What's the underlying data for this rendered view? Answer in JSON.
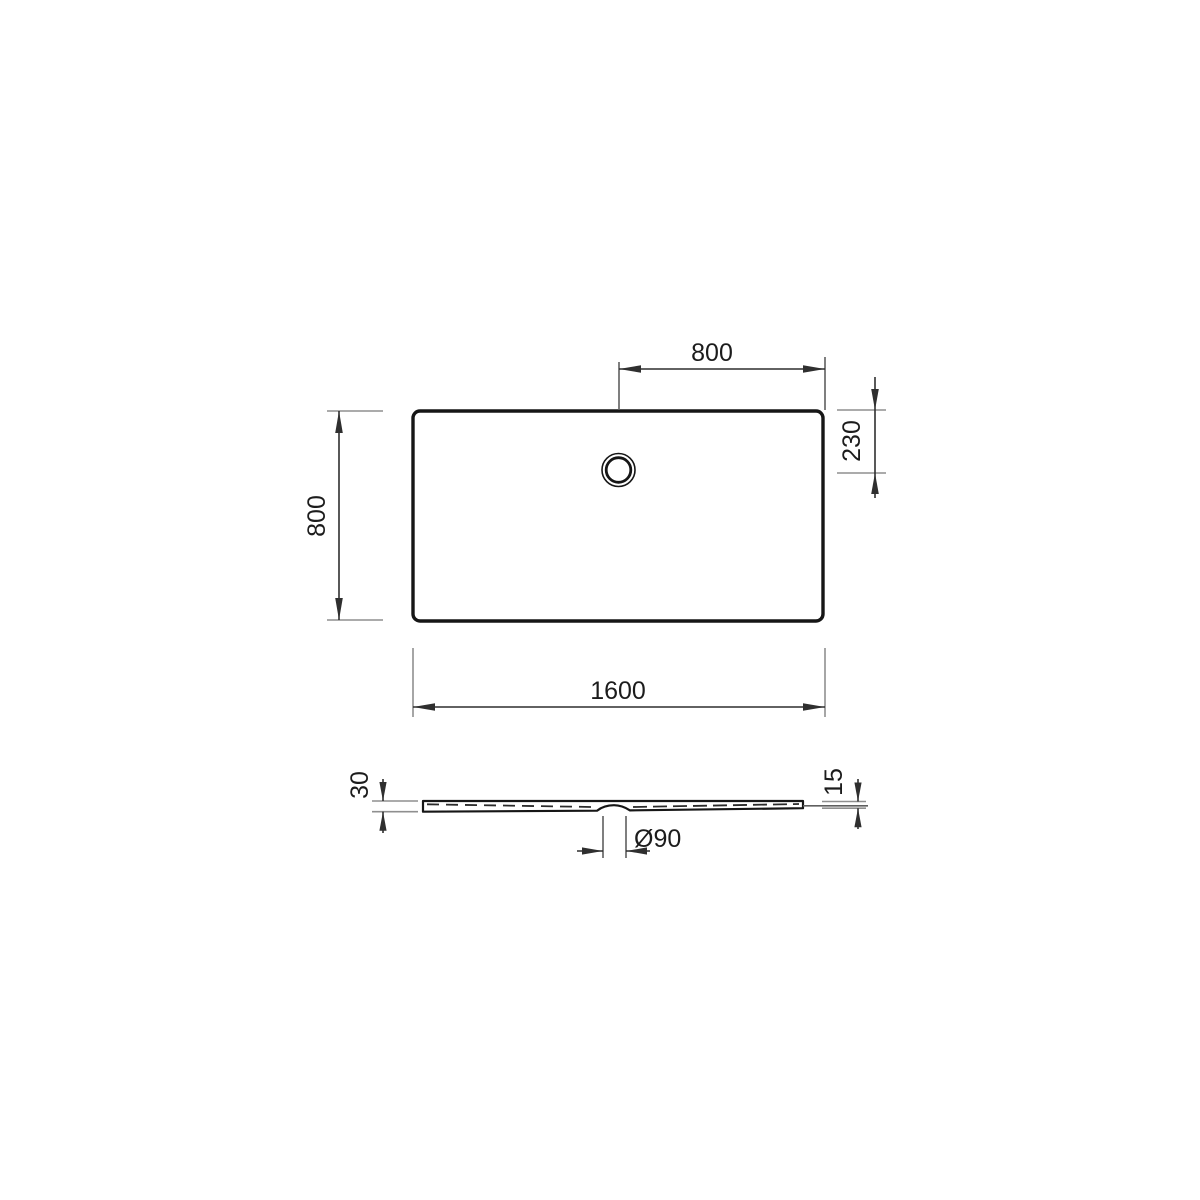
{
  "colors": {
    "background": "#ffffff",
    "object_line": "#161616",
    "dimension_line": "#2f2f2f",
    "extension_line": "#8f8f8f"
  },
  "dims": {
    "drain_to_right": "800",
    "top_to_drain": "230",
    "depth": "800",
    "width": "1600",
    "edge_height": "30",
    "rim_height": "15",
    "drain_diameter": "Ø90"
  }
}
